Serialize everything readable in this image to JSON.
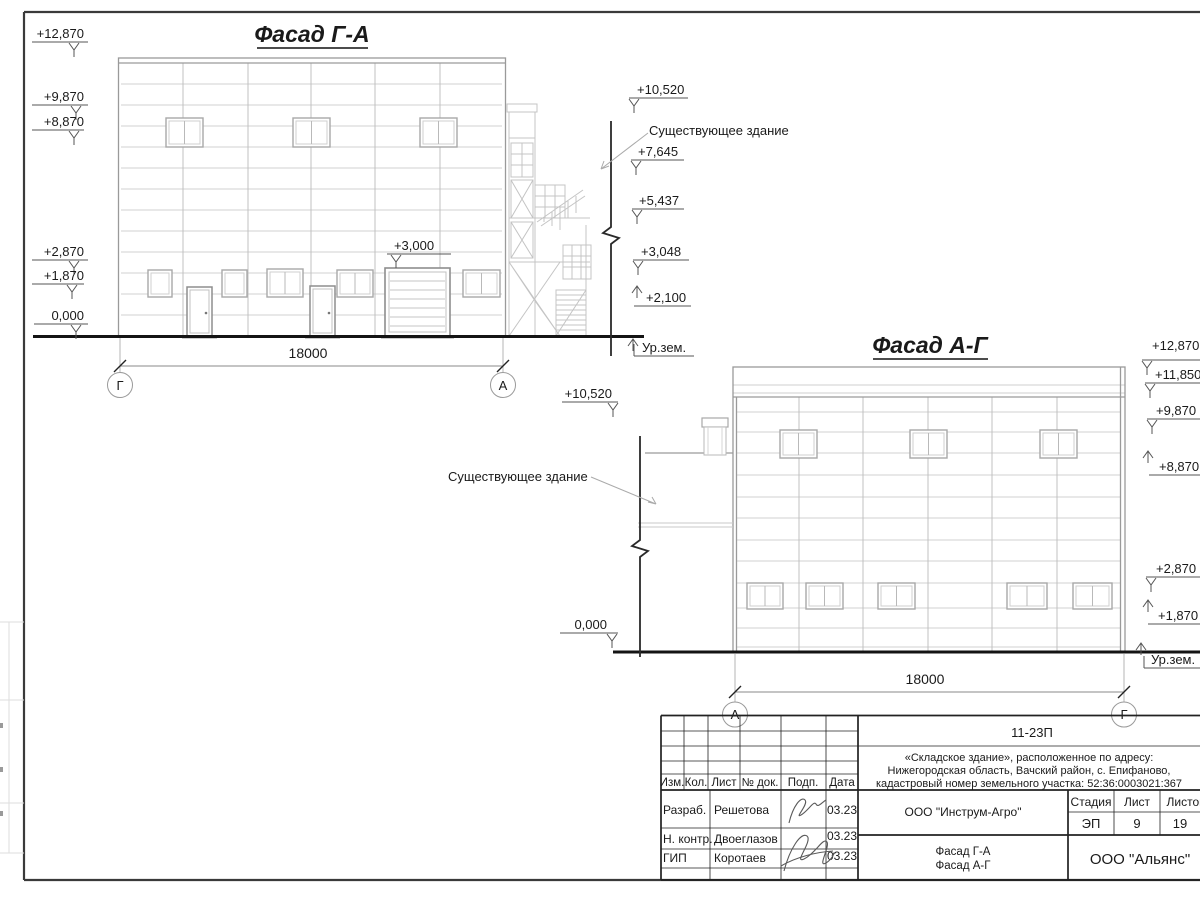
{
  "facade1": {
    "title": "Фасад Г-А",
    "left_marks": [
      "+12,870",
      "+9,870",
      "+8,870",
      "+2,870",
      "+1,870",
      "0,000"
    ],
    "right_marks": [
      "+10,520",
      "+7,645",
      "+5,437",
      "+3,048",
      "+2,100"
    ],
    "gate_mark": "+3,000",
    "existing_building_label": "Существующее здание",
    "ground_label": "Ур.зем.",
    "dimension": "18000",
    "axis_left": "Г",
    "axis_right": "А"
  },
  "facade2": {
    "title": "Фасад А-Г",
    "left_marks": [
      "+10,520",
      "0,000"
    ],
    "right_marks": [
      "+12,870",
      "+11,850",
      "+9,870",
      "+8,870",
      "+2,870",
      "+1,870"
    ],
    "existing_building_label": "Существующее здание",
    "ground_label": "Ур.зем.",
    "dimension": "18000",
    "axis_left": "А",
    "axis_right": "Г"
  },
  "title_block": {
    "project_code": "11-23П",
    "address_line1": "«Складское здание», расположенное по адресу:",
    "address_line2": "Нижегородская область, Вачский район, с. Епифаново,",
    "address_line3": "кадастровый номер земельного участка: 52:36:0003021:367",
    "col_izm": "Изм.",
    "col_kol": "Кол.",
    "col_list": "Лист",
    "col_dok": "№ док.",
    "col_podp": "Подп.",
    "col_data": "Дата",
    "row1_role": "Разраб.",
    "row1_name": "Решетова",
    "row1_date": "03.23",
    "row2_role": "Н. контр.",
    "row2_name": "Двоеглазов",
    "row2_date": "03.23",
    "row3_role": "ГИП",
    "row3_name": "Коротаев",
    "row3_date": "03.23",
    "org": "ООО \"Инструм-Агро\"",
    "stage_label": "Стадия",
    "stage_value": "ЭП",
    "sheet_label": "Лист",
    "sheet_value": "9",
    "sheets_label": "Листов",
    "sheets_value": "19",
    "drawing_name_line1": "Фасад Г-А",
    "drawing_name_line2": "Фасад А-Г",
    "company": "ООО \"Альянс\""
  }
}
